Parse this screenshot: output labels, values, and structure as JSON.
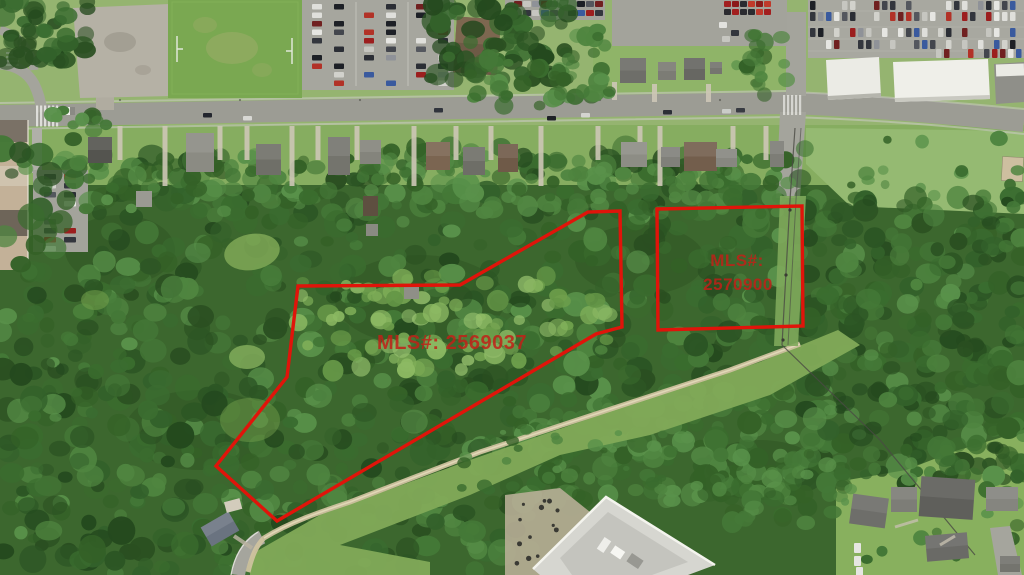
{
  "annotations": {
    "boundary_color": "#e0140a",
    "label_color": "#c22018",
    "parcel_large": {
      "mls_label": "MLS#: 2569037"
    },
    "parcel_small": {
      "mls_label_line1": "MLS#:",
      "mls_label_line2": "2570900"
    }
  }
}
